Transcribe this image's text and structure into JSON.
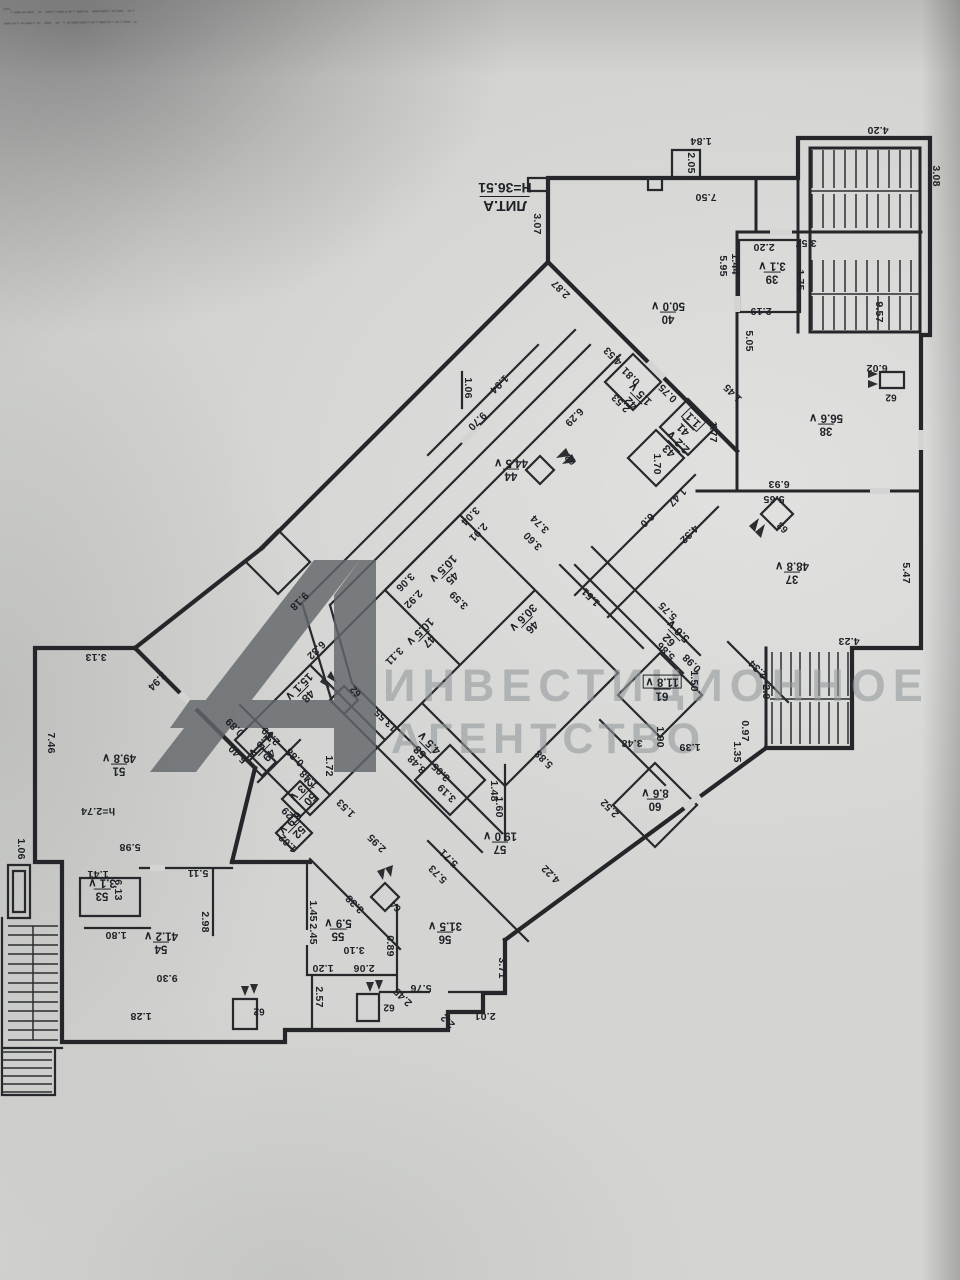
{
  "plan": {
    "title_lit": "ЛИТ.А",
    "height_note": "Н=36.51",
    "mezz_note": "h=2.74"
  },
  "stamp": {
    "line1": "‾‾·—–— – —·—‑–·—– ——·–— –·",
    "line2": "—–·–—·– — – ·–——·–·—–·–·— ‑"
  },
  "watermark": {
    "logo": "А1",
    "line1": "ИНВЕСТИЦИОННОЕ",
    "line2": "АГЕНТСТВО"
  },
  "colors": {
    "ink": "#24262a",
    "paper": "#d4d5d2",
    "watermark_logo": "#63676b",
    "watermark_text": "#94999d"
  },
  "rooms": [
    {
      "num": "37",
      "area": "48.8",
      "x": 792,
      "y": 572,
      "rot": 180,
      "check": true
    },
    {
      "num": "38",
      "area": "56.6",
      "x": 826,
      "y": 424,
      "rot": 180,
      "check": true
    },
    {
      "num": "39",
      "area": "3.1",
      "x": 772,
      "y": 272,
      "rot": 180,
      "check": true
    },
    {
      "num": "40",
      "area": "50.0",
      "x": 668,
      "y": 312,
      "rot": 180,
      "check": true
    },
    {
      "num": "41",
      "area": "1.1",
      "x": 689,
      "y": 424,
      "rot": 225,
      "check": false,
      "boxed": true
    },
    {
      "num": "42",
      "area": "1.5",
      "x": 636,
      "y": 398,
      "rot": 225,
      "check": true
    },
    {
      "num": "43",
      "area": "2.2",
      "x": 674,
      "y": 446,
      "rot": 225,
      "check": true
    },
    {
      "num": "44",
      "area": "44.5",
      "x": 511,
      "y": 469,
      "rot": 180,
      "check": true
    },
    {
      "num": "45",
      "area": "10.5",
      "x": 447,
      "y": 573,
      "rot": 135,
      "check": true
    },
    {
      "num": "46",
      "area": "30.6",
      "x": 527,
      "y": 622,
      "rot": 135,
      "check": true
    },
    {
      "num": "47",
      "area": "10.5",
      "x": 424,
      "y": 636,
      "rot": 135,
      "check": true
    },
    {
      "num": "48",
      "area": "15.1",
      "x": 303,
      "y": 691,
      "rot": 135,
      "check": true
    },
    {
      "num": "49",
      "area": "1.5",
      "x": 264,
      "y": 750,
      "rot": 135,
      "check": true
    },
    {
      "num": "50",
      "area": "2.3",
      "x": 305,
      "y": 794,
      "rot": 135,
      "check": true
    },
    {
      "num": "51",
      "area": "49.8",
      "x": 119,
      "y": 764,
      "rot": 180,
      "check": true
    },
    {
      "num": "52",
      "area": "6.9",
      "x": 294,
      "y": 827,
      "rot": 135,
      "check": true
    },
    {
      "num": "53",
      "area": "3.1",
      "x": 102,
      "y": 889,
      "rot": 180,
      "check": true
    },
    {
      "num": "54",
      "area": "41.2",
      "x": 161,
      "y": 942,
      "rot": 180,
      "check": true
    },
    {
      "num": "55",
      "area": "5.9",
      "x": 338,
      "y": 929,
      "rot": 180,
      "check": true
    },
    {
      "num": "56",
      "area": "31.5",
      "x": 445,
      "y": 932,
      "rot": 180,
      "check": true
    },
    {
      "num": "57",
      "area": "19.0",
      "x": 500,
      "y": 842,
      "rot": 180,
      "check": true
    },
    {
      "num": "58",
      "area": "4.5",
      "x": 425,
      "y": 747,
      "rot": 225,
      "check": true
    },
    {
      "num": "60",
      "area": "8.6",
      "x": 655,
      "y": 799,
      "rot": 180,
      "check": true
    },
    {
      "num": "61",
      "area": "11.8",
      "x": 662,
      "y": 688,
      "rot": 180,
      "check": true,
      "boxed": true
    },
    {
      "num": "62",
      "area": "5.6",
      "x": 674,
      "y": 635,
      "rot": 225,
      "check": true
    }
  ],
  "shaft_labels": [
    {
      "t": "62",
      "x": 891,
      "y": 397,
      "rot": 180
    },
    {
      "t": "62",
      "x": 571,
      "y": 459,
      "rot": 225
    },
    {
      "t": "63",
      "x": 783,
      "y": 527,
      "rot": 225
    },
    {
      "t": "62",
      "x": 356,
      "y": 691,
      "rot": 225
    },
    {
      "t": "64",
      "x": 396,
      "y": 906,
      "rot": 225
    },
    {
      "t": "62",
      "x": 389,
      "y": 1007,
      "rot": 180
    },
    {
      "t": "62",
      "x": 259,
      "y": 1011,
      "rot": 180
    }
  ],
  "dims": [
    {
      "t": "7.50",
      "x": 706,
      "y": 197,
      "rot": 180
    },
    {
      "t": "3.07",
      "x": 537,
      "y": 224,
      "rot": 90
    },
    {
      "t": "1.84",
      "x": 701,
      "y": 141,
      "rot": 180
    },
    {
      "t": "2.05",
      "x": 691,
      "y": 163,
      "rot": 90
    },
    {
      "t": "4.20",
      "x": 878,
      "y": 130,
      "rot": 180
    },
    {
      "t": "3.08",
      "x": 936,
      "y": 176,
      "rot": 90
    },
    {
      "t": "3.57",
      "x": 806,
      "y": 243,
      "rot": 180
    },
    {
      "t": "2.20",
      "x": 764,
      "y": 247,
      "rot": 180
    },
    {
      "t": "1.75",
      "x": 800,
      "y": 280,
      "rot": 90
    },
    {
      "t": "1.44",
      "x": 735,
      "y": 264,
      "rot": 90
    },
    {
      "t": "5.95",
      "x": 723,
      "y": 266,
      "rot": 90
    },
    {
      "t": "2.19",
      "x": 761,
      "y": 311,
      "rot": 180
    },
    {
      "t": "9.57",
      "x": 879,
      "y": 312,
      "rot": 90
    },
    {
      "t": "5.05",
      "x": 749,
      "y": 341,
      "rot": 90
    },
    {
      "t": "6.02",
      "x": 877,
      "y": 368,
      "rot": 180
    },
    {
      "t": "2.87",
      "x": 561,
      "y": 289,
      "rot": 225
    },
    {
      "t": "4.53",
      "x": 613,
      "y": 356,
      "rot": 225
    },
    {
      "t": "0.81",
      "x": 631,
      "y": 376,
      "rot": 225
    },
    {
      "t": "2.53",
      "x": 621,
      "y": 403,
      "rot": 225
    },
    {
      "t": "0.75",
      "x": 668,
      "y": 393,
      "rot": 225
    },
    {
      "t": "1.45",
      "x": 733,
      "y": 393,
      "rot": 225
    },
    {
      "t": "1.77",
      "x": 713,
      "y": 432,
      "rot": 90
    },
    {
      "t": "1.70",
      "x": 657,
      "y": 464,
      "rot": 90
    },
    {
      "t": "1.06",
      "x": 468,
      "y": 388,
      "rot": 90
    },
    {
      "t": "1.94",
      "x": 499,
      "y": 384,
      "rot": 135
    },
    {
      "t": "9.70",
      "x": 477,
      "y": 421,
      "rot": 135
    },
    {
      "t": "6.29",
      "x": 574,
      "y": 417,
      "rot": 135
    },
    {
      "t": "1.47",
      "x": 677,
      "y": 497,
      "rot": 135
    },
    {
      "t": "6.0",
      "x": 647,
      "y": 520,
      "rot": 135
    },
    {
      "t": "4.32",
      "x": 689,
      "y": 534,
      "rot": 135
    },
    {
      "t": "6.93",
      "x": 779,
      "y": 484,
      "rot": 180
    },
    {
      "t": "5.65",
      "x": 774,
      "y": 499,
      "rot": 180
    },
    {
      "t": "5.47",
      "x": 906,
      "y": 573,
      "rot": 90
    },
    {
      "t": "4.23",
      "x": 849,
      "y": 641,
      "rot": 180
    },
    {
      "t": "2.34",
      "x": 758,
      "y": 669,
      "rot": 225
    },
    {
      "t": "2.9",
      "x": 766,
      "y": 692,
      "rot": 90
    },
    {
      "t": "0.97",
      "x": 745,
      "y": 731,
      "rot": 90
    },
    {
      "t": "1.35",
      "x": 737,
      "y": 752,
      "rot": 90
    },
    {
      "t": "3.04",
      "x": 470,
      "y": 516,
      "rot": 135
    },
    {
      "t": "2.91",
      "x": 478,
      "y": 532,
      "rot": 135
    },
    {
      "t": "3.74",
      "x": 540,
      "y": 524,
      "rot": 225
    },
    {
      "t": "3.60",
      "x": 533,
      "y": 541,
      "rot": 225
    },
    {
      "t": "3.06",
      "x": 405,
      "y": 582,
      "rot": 135
    },
    {
      "t": "2.92",
      "x": 413,
      "y": 599,
      "rot": 135
    },
    {
      "t": "3.59",
      "x": 459,
      "y": 600,
      "rot": 225
    },
    {
      "t": "3.11",
      "x": 394,
      "y": 656,
      "rot": 135
    },
    {
      "t": "9.18",
      "x": 299,
      "y": 601,
      "rot": 135
    },
    {
      "t": "6.32",
      "x": 316,
      "y": 650,
      "rot": 135
    },
    {
      "t": "1.51",
      "x": 591,
      "y": 597,
      "rot": 225
    },
    {
      "t": "5.75",
      "x": 668,
      "y": 611,
      "rot": 225
    },
    {
      "t": "5.86",
      "x": 666,
      "y": 651,
      "rot": 225
    },
    {
      "t": "0.98",
      "x": 692,
      "y": 663,
      "rot": 225
    },
    {
      "t": "1.50",
      "x": 694,
      "y": 681,
      "rot": 90
    },
    {
      "t": "1.90",
      "x": 660,
      "y": 737,
      "rot": 90
    },
    {
      "t": "3.48",
      "x": 632,
      "y": 743,
      "rot": 180
    },
    {
      "t": "1.39",
      "x": 690,
      "y": 747,
      "rot": 180
    },
    {
      "t": "2.52",
      "x": 610,
      "y": 808,
      "rot": 225
    },
    {
      "t": "3.13",
      "x": 96,
      "y": 657,
      "rot": 180
    },
    {
      "t": "2.94",
      "x": 157,
      "y": 681,
      "rot": 135
    },
    {
      "t": "7.46",
      "x": 51,
      "y": 743,
      "rot": 90
    },
    {
      "t": "5.98",
      "x": 130,
      "y": 847,
      "rot": 180
    },
    {
      "t": "1.06",
      "x": 21,
      "y": 849,
      "rot": 90
    },
    {
      "t": "0.89",
      "x": 235,
      "y": 727,
      "rot": 225
    },
    {
      "t": "2.50",
      "x": 271,
      "y": 736,
      "rot": 225
    },
    {
      "t": "5.40",
      "x": 238,
      "y": 754,
      "rot": 225
    },
    {
      "t": "0.88",
      "x": 295,
      "y": 757,
      "rot": 225
    },
    {
      "t": "1.72",
      "x": 329,
      "y": 766,
      "rot": 90
    },
    {
      "t": "1.48",
      "x": 309,
      "y": 779,
      "rot": 225
    },
    {
      "t": "1.53",
      "x": 346,
      "y": 808,
      "rot": 225
    },
    {
      "t": "1.29",
      "x": 291,
      "y": 816,
      "rot": 225
    },
    {
      "t": "1.62",
      "x": 288,
      "y": 843,
      "rot": 225
    },
    {
      "t": "2.95",
      "x": 377,
      "y": 843,
      "rot": 225
    },
    {
      "t": "13.55",
      "x": 386,
      "y": 720,
      "rot": 225
    },
    {
      "t": "8.48",
      "x": 417,
      "y": 764,
      "rot": 225
    },
    {
      "t": "3.05",
      "x": 441,
      "y": 772,
      "rot": 225
    },
    {
      "t": "3.19",
      "x": 447,
      "y": 793,
      "rot": 225
    },
    {
      "t": "1.48",
      "x": 494,
      "y": 791,
      "rot": 90
    },
    {
      "t": "1.60",
      "x": 499,
      "y": 807,
      "rot": 90
    },
    {
      "t": "5.88",
      "x": 544,
      "y": 759,
      "rot": 225
    },
    {
      "t": "5.71",
      "x": 449,
      "y": 858,
      "rot": 225
    },
    {
      "t": "5.73",
      "x": 438,
      "y": 874,
      "rot": 225
    },
    {
      "t": "4.22",
      "x": 551,
      "y": 874,
      "rot": 225
    },
    {
      "t": "2.98",
      "x": 205,
      "y": 922,
      "rot": 90
    },
    {
      "t": "5.11",
      "x": 198,
      "y": 873,
      "rot": 180
    },
    {
      "t": "6.13",
      "x": 118,
      "y": 890,
      "rot": 90
    },
    {
      "t": "1.41",
      "x": 98,
      "y": 874,
      "rot": 180
    },
    {
      "t": "1.80",
      "x": 116,
      "y": 935,
      "rot": 180
    },
    {
      "t": "9.30",
      "x": 167,
      "y": 978,
      "rot": 180
    },
    {
      "t": "1.28",
      "x": 141,
      "y": 1016,
      "rot": 180
    },
    {
      "t": "3.38",
      "x": 355,
      "y": 904,
      "rot": 225
    },
    {
      "t": "1.45",
      "x": 313,
      "y": 911,
      "rot": 90
    },
    {
      "t": "2.45",
      "x": 313,
      "y": 934,
      "rot": 90
    },
    {
      "t": "3.10",
      "x": 354,
      "y": 950,
      "rot": 180
    },
    {
      "t": "0.89",
      "x": 390,
      "y": 946,
      "rot": 90
    },
    {
      "t": "2.06",
      "x": 364,
      "y": 968,
      "rot": 180
    },
    {
      "t": "1.20",
      "x": 323,
      "y": 968,
      "rot": 180
    },
    {
      "t": "2.57",
      "x": 319,
      "y": 997,
      "rot": 90
    },
    {
      "t": "5.76",
      "x": 421,
      "y": 988,
      "rot": 180
    },
    {
      "t": "2.45",
      "x": 403,
      "y": 997,
      "rot": 225
    },
    {
      "t": "2.2",
      "x": 448,
      "y": 1021,
      "rot": 225
    },
    {
      "t": "2.01",
      "x": 485,
      "y": 1016,
      "rot": 180
    },
    {
      "t": "3.71",
      "x": 502,
      "y": 968,
      "rot": 90
    }
  ]
}
